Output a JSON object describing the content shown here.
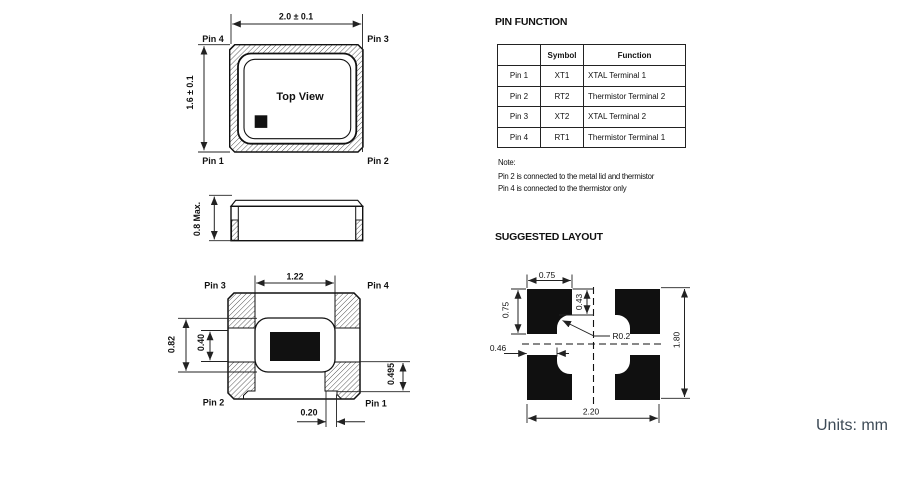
{
  "page": {
    "units_label": "Units: mm"
  },
  "top_view": {
    "label": "Top View",
    "dim_width": "2.0 ± 0.1",
    "dim_height": "1.6 ± 0.1",
    "pin_top_left": "Pin 4",
    "pin_top_right": "Pin 3",
    "pin_bottom_left": "Pin 1",
    "pin_bottom_right": "Pin 2"
  },
  "side_view": {
    "dim_height": "0.8 Max."
  },
  "bottom_view": {
    "pin_top_left": "Pin 3",
    "pin_top_right": "Pin 4",
    "pin_bottom_left": "Pin 2",
    "pin_bottom_right": "Pin 1",
    "dim_cavity_width": "1.22",
    "dim_cavity_height": "0.82",
    "dim_inner_height": "0.40",
    "dim_pad_height": "0.495",
    "dim_step": "0.20"
  },
  "pin_function": {
    "title": "PIN FUNCTION",
    "headers": [
      "",
      "Symbol",
      "Function"
    ],
    "rows": [
      {
        "pin": "Pin 1",
        "symbol": "XT1",
        "function": "XTAL Terminal 1"
      },
      {
        "pin": "Pin 2",
        "symbol": "RT2",
        "function": "Thermistor Terminal 2"
      },
      {
        "pin": "Pin 3",
        "symbol": "XT2",
        "function": "XTAL Terminal 2"
      },
      {
        "pin": "Pin 4",
        "symbol": "RT1",
        "function": "Thermistor Terminal 1"
      }
    ],
    "note_title": "Note:",
    "note_line1": "Pin 2 is connected to the metal lid and thermistor",
    "note_line2": "Pin 4 is connected to the thermistor only"
  },
  "suggested_layout": {
    "title": "SUGGESTED LAYOUT",
    "dim_pad_width": "0.75",
    "dim_pad_height": "0.75",
    "dim_notch_top": "0.43",
    "dim_notch_side": "0.46",
    "dim_corner_radius": "R0.2",
    "dim_total_width": "2.20",
    "dim_total_height": "1.80"
  },
  "colors": {
    "line": "#111111",
    "pad_fill": "#101010",
    "units_text": "#3d4a56"
  }
}
